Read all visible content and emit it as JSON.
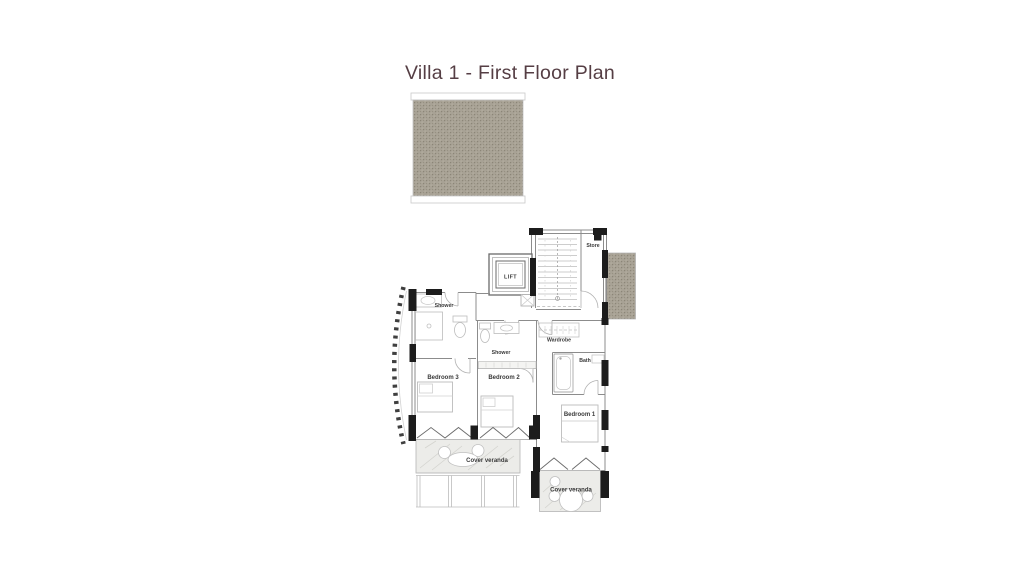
{
  "title": {
    "text": "Villa 1 - First Floor Plan"
  },
  "colors": {
    "title": "#553e44",
    "wall_pier": "#1c1c1c",
    "wall_line": "#8c8c8c",
    "texture_base": "#a8a295",
    "veranda_fill": "#ecece9"
  },
  "plan": {
    "rooms": {
      "lift": {
        "label": "LIFT"
      },
      "store": {
        "label": "Store"
      },
      "shower_top": {
        "label": "Shower"
      },
      "shower_mid": {
        "label": "Shower"
      },
      "wardrobe": {
        "label": "Wardrobe"
      },
      "bath": {
        "label": "Bath"
      },
      "bedroom1": {
        "label": "Bedroom 1"
      },
      "bedroom2": {
        "label": "Bedroom 2"
      },
      "bedroom3": {
        "label": "Bedroom 3"
      },
      "veranda_left": {
        "label": "Cover veranda"
      },
      "veranda_right": {
        "label": "Cover veranda"
      }
    }
  }
}
